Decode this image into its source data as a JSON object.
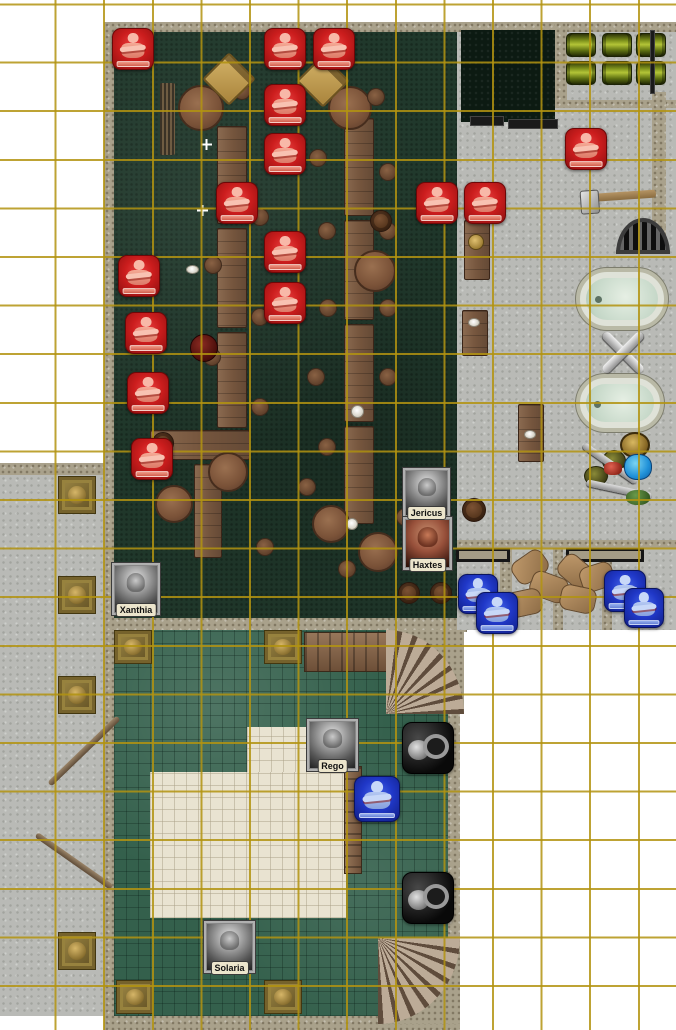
{
  "scene": {
    "title": "fantasy-tavern-battle-map",
    "kind": "virtual-tabletop-map",
    "grid": {
      "cell_px": 48.6,
      "offset_x": 6,
      "offset_y": 13,
      "line_color": "#b29310"
    }
  },
  "palette": {
    "red_token": "#cb1d1d",
    "blue_token": "#2038c8",
    "tavern_floor": "#20382b",
    "marble_floor": "#34604c",
    "stone_floor": "#b9bab6",
    "gravel": "#a9a18b",
    "cream_tiles": "#e9e3d1",
    "pool": "#0c1a12",
    "keg_green": "#8a9a20"
  },
  "characters": [
    {
      "name": "Xanthia",
      "x": 112,
      "y": 563,
      "w": 48,
      "h": 52,
      "portrait": "gray"
    },
    {
      "name": "Jericus",
      "x": 403,
      "y": 468,
      "w": 47,
      "h": 50,
      "portrait": "gray"
    },
    {
      "name": "Haxtes",
      "x": 403,
      "y": 517,
      "w": 49,
      "h": 53,
      "portrait": "color"
    },
    {
      "name": "Rego",
      "x": 307,
      "y": 719,
      "w": 51,
      "h": 52,
      "portrait": "gray"
    },
    {
      "name": "Solaria",
      "x": 204,
      "y": 921,
      "w": 51,
      "h": 52,
      "portrait": "gray"
    }
  ],
  "status_tokens": {
    "red": {
      "icon": "crossed-arms-figure-icon",
      "count": 15,
      "size": 42,
      "positions": [
        [
          112,
          28
        ],
        [
          264,
          28
        ],
        [
          313,
          28
        ],
        [
          264,
          84
        ],
        [
          264,
          133
        ],
        [
          216,
          182
        ],
        [
          416,
          182
        ],
        [
          464,
          182
        ],
        [
          264,
          231
        ],
        [
          118,
          255
        ],
        [
          264,
          282
        ],
        [
          125,
          312
        ],
        [
          127,
          372
        ],
        [
          131,
          438
        ],
        [
          565,
          128
        ]
      ]
    },
    "blue": {
      "icon": "crossed-arms-figure-icon",
      "count": 5,
      "positions": [
        [
          458,
          574,
          40
        ],
        [
          476,
          592,
          42
        ],
        [
          604,
          570,
          42
        ],
        [
          624,
          588,
          40
        ],
        [
          354,
          776,
          46
        ]
      ]
    }
  },
  "object_tokens": {
    "pot_pile": {
      "icon": "metal-pots-icon",
      "positions": [
        [
          402,
          722,
          52,
          52
        ],
        [
          402,
          872,
          52,
          52
        ]
      ]
    }
  },
  "objects": [
    {
      "k": "long-table",
      "r": [
        217,
        126,
        30,
        98
      ]
    },
    {
      "k": "long-table",
      "r": [
        217,
        228,
        30,
        100
      ]
    },
    {
      "k": "long-table",
      "r": [
        217,
        332,
        30,
        96
      ]
    },
    {
      "k": "long-table",
      "r": [
        150,
        430,
        100,
        30
      ]
    },
    {
      "k": "long-table",
      "r": [
        194,
        464,
        28,
        94
      ]
    },
    {
      "k": "long-table",
      "r": [
        344,
        118,
        30,
        98
      ]
    },
    {
      "k": "long-table",
      "r": [
        344,
        220,
        30,
        100
      ]
    },
    {
      "k": "long-table",
      "r": [
        344,
        324,
        30,
        98
      ]
    },
    {
      "k": "long-table",
      "r": [
        344,
        426,
        30,
        98
      ]
    },
    {
      "k": "wood-table",
      "r": [
        464,
        220,
        26,
        60
      ]
    },
    {
      "k": "wood-table",
      "r": [
        462,
        310,
        26,
        46
      ]
    },
    {
      "k": "wood-table",
      "r": [
        518,
        404,
        26,
        58
      ]
    },
    {
      "k": "walkway",
      "r": [
        304,
        632,
        92,
        40
      ]
    },
    {
      "k": "ladder",
      "r": [
        344,
        766,
        18,
        108
      ]
    },
    {
      "k": "round-table",
      "r": [
        178,
        85,
        46,
        46
      ]
    },
    {
      "k": "round-table",
      "r": [
        328,
        86,
        44,
        44
      ]
    },
    {
      "k": "round-table",
      "r": [
        354,
        250,
        42,
        42
      ]
    },
    {
      "k": "round-table",
      "r": [
        208,
        452,
        40,
        40
      ]
    },
    {
      "k": "round-table",
      "r": [
        155,
        485,
        38,
        38
      ]
    },
    {
      "k": "round-table",
      "r": [
        312,
        505,
        38,
        38
      ]
    },
    {
      "k": "round-table",
      "r": [
        358,
        532,
        40,
        40
      ]
    },
    {
      "k": "stool",
      "r": [
        233,
        82,
        18,
        18
      ]
    },
    {
      "k": "stool",
      "r": [
        367,
        88,
        18,
        18
      ]
    },
    {
      "k": "stool",
      "r": [
        309,
        149,
        18,
        18
      ]
    },
    {
      "k": "stool",
      "r": [
        379,
        163,
        18,
        18
      ]
    },
    {
      "k": "stool",
      "r": [
        318,
        222,
        18,
        18
      ]
    },
    {
      "k": "stool",
      "r": [
        379,
        222,
        18,
        18
      ]
    },
    {
      "k": "stool",
      "r": [
        204,
        256,
        18,
        18
      ]
    },
    {
      "k": "stool",
      "r": [
        319,
        299,
        18,
        18
      ]
    },
    {
      "k": "stool",
      "r": [
        379,
        299,
        18,
        18
      ]
    },
    {
      "k": "stool",
      "r": [
        307,
        368,
        18,
        18
      ]
    },
    {
      "k": "stool",
      "r": [
        379,
        368,
        18,
        18
      ]
    },
    {
      "k": "stool",
      "r": [
        318,
        438,
        18,
        18
      ]
    },
    {
      "k": "stool",
      "r": [
        251,
        208,
        18,
        18
      ]
    },
    {
      "k": "stool",
      "r": [
        251,
        308,
        18,
        18
      ]
    },
    {
      "k": "stool",
      "r": [
        251,
        398,
        18,
        18
      ]
    },
    {
      "k": "stool",
      "r": [
        203,
        348,
        18,
        18
      ]
    },
    {
      "k": "stool",
      "r": [
        338,
        560,
        18,
        18
      ]
    },
    {
      "k": "stool",
      "r": [
        298,
        478,
        18,
        18
      ]
    },
    {
      "k": "stool",
      "r": [
        396,
        508,
        18,
        18
      ]
    },
    {
      "k": "stool",
      "r": [
        256,
        538,
        18,
        18
      ]
    },
    {
      "k": "barrel",
      "r": [
        370,
        210,
        22,
        22
      ]
    },
    {
      "k": "barrel",
      "r": [
        152,
        432,
        22,
        22
      ]
    },
    {
      "k": "barrel",
      "r": [
        398,
        582,
        22,
        22
      ]
    },
    {
      "k": "barrel",
      "r": [
        430,
        582,
        22,
        22
      ]
    },
    {
      "k": "barrel",
      "r": [
        462,
        498,
        24,
        24
      ]
    },
    {
      "k": "dark-pot",
      "r": [
        190,
        334,
        28,
        28
      ]
    },
    {
      "k": "plate",
      "r": [
        186,
        265,
        13,
        9
      ]
    },
    {
      "k": "plate",
      "r": [
        351,
        405,
        13,
        13
      ]
    },
    {
      "k": "plate",
      "r": [
        346,
        518,
        12,
        12
      ]
    },
    {
      "k": "plate",
      "r": [
        468,
        318,
        12,
        9
      ]
    },
    {
      "k": "plate",
      "r": [
        524,
        430,
        12,
        9
      ]
    },
    {
      "k": "gold-plate",
      "r": [
        468,
        234,
        16,
        16
      ]
    },
    {
      "k": "chair",
      "r": [
        210,
        60,
        38,
        38,
        45
      ]
    },
    {
      "k": "chair",
      "r": [
        304,
        62,
        38,
        38,
        45
      ]
    },
    {
      "k": "stick-bundle",
      "r": [
        160,
        83,
        15,
        72
      ]
    },
    {
      "k": "sparkle",
      "r": [
        201,
        139,
        11,
        11
      ]
    },
    {
      "k": "sparkle",
      "r": [
        197,
        205,
        11,
        11
      ]
    },
    {
      "k": "keg-green",
      "r": [
        566,
        33,
        30,
        24
      ]
    },
    {
      "k": "keg-green",
      "r": [
        602,
        33,
        30,
        24
      ]
    },
    {
      "k": "keg-green",
      "r": [
        636,
        33,
        30,
        24
      ]
    },
    {
      "k": "keg-green",
      "r": [
        566,
        61,
        30,
        24
      ]
    },
    {
      "k": "keg-green",
      "r": [
        602,
        61,
        30,
        24
      ]
    },
    {
      "k": "keg-green",
      "r": [
        636,
        61,
        30,
        24
      ]
    },
    {
      "k": "hammer",
      "r": [
        584,
        192,
        72,
        8,
        -4
      ]
    },
    {
      "k": "grate",
      "r": [
        616,
        218,
        54,
        36
      ]
    },
    {
      "k": "tub",
      "r": [
        576,
        268,
        92,
        62
      ]
    },
    {
      "k": "tub",
      "r": [
        576,
        374,
        88,
        58
      ]
    },
    {
      "k": "valve",
      "r": [
        596,
        328,
        54,
        50
      ]
    },
    {
      "k": "lantern",
      "r": [
        620,
        432,
        30,
        26
      ]
    },
    {
      "k": "pot-olive",
      "r": [
        602,
        450,
        24,
        22
      ]
    },
    {
      "k": "pot-olive",
      "r": [
        584,
        466,
        24,
        20
      ]
    },
    {
      "k": "tool",
      "r": [
        578,
        460,
        64,
        7,
        35
      ]
    },
    {
      "k": "tool",
      "r": [
        586,
        486,
        66,
        7,
        12
      ]
    },
    {
      "k": "item-red",
      "r": [
        604,
        462,
        18,
        13
      ]
    },
    {
      "k": "pouch-blue",
      "r": [
        624,
        454,
        28,
        26
      ]
    },
    {
      "k": "item-green",
      "r": [
        626,
        490,
        24,
        15
      ]
    },
    {
      "k": "bench",
      "r": [
        456,
        548,
        54,
        14
      ]
    },
    {
      "k": "bench",
      "r": [
        566,
        548,
        78,
        14
      ]
    },
    {
      "k": "wallbar",
      "r": [
        470,
        116,
        34,
        10
      ]
    },
    {
      "k": "wallbar",
      "r": [
        508,
        119,
        50,
        10
      ]
    },
    {
      "k": "wallbar",
      "r": [
        650,
        30,
        5,
        64
      ]
    },
    {
      "k": "sack",
      "r": [
        512,
        554,
        36,
        26,
        -35
      ]
    },
    {
      "k": "sack",
      "r": [
        530,
        574,
        38,
        26,
        20
      ]
    },
    {
      "k": "sack",
      "r": [
        506,
        590,
        36,
        26,
        -12
      ]
    },
    {
      "k": "sack",
      "r": [
        558,
        558,
        34,
        26,
        40
      ]
    },
    {
      "k": "sack",
      "r": [
        580,
        564,
        34,
        26,
        -18
      ]
    },
    {
      "k": "sack",
      "r": [
        560,
        586,
        36,
        26,
        12
      ]
    },
    {
      "k": "staff",
      "r": [
        36,
        748,
        96,
        6,
        -44
      ]
    },
    {
      "k": "staff",
      "r": [
        28,
        858,
        92,
        6,
        35
      ]
    },
    {
      "k": "pillar-gold",
      "r": [
        58,
        476,
        38,
        38
      ]
    },
    {
      "k": "pillar-gold",
      "r": [
        58,
        576,
        38,
        38
      ]
    },
    {
      "k": "pillar-gold",
      "r": [
        58,
        676,
        38,
        38
      ]
    },
    {
      "k": "pillar-gold",
      "r": [
        58,
        932,
        38,
        38
      ]
    },
    {
      "k": "pillar-gold",
      "r": [
        114,
        630,
        38,
        34
      ]
    },
    {
      "k": "pillar-gold",
      "r": [
        264,
        630,
        38,
        34
      ]
    },
    {
      "k": "pillar-gold",
      "r": [
        116,
        980,
        38,
        34
      ]
    },
    {
      "k": "pillar-gold",
      "r": [
        264,
        980,
        38,
        34
      ]
    },
    {
      "k": "stairs-top",
      "r": [
        386,
        630,
        78,
        84
      ]
    },
    {
      "k": "stairs-bottom",
      "r": [
        378,
        938,
        82,
        86
      ]
    }
  ]
}
